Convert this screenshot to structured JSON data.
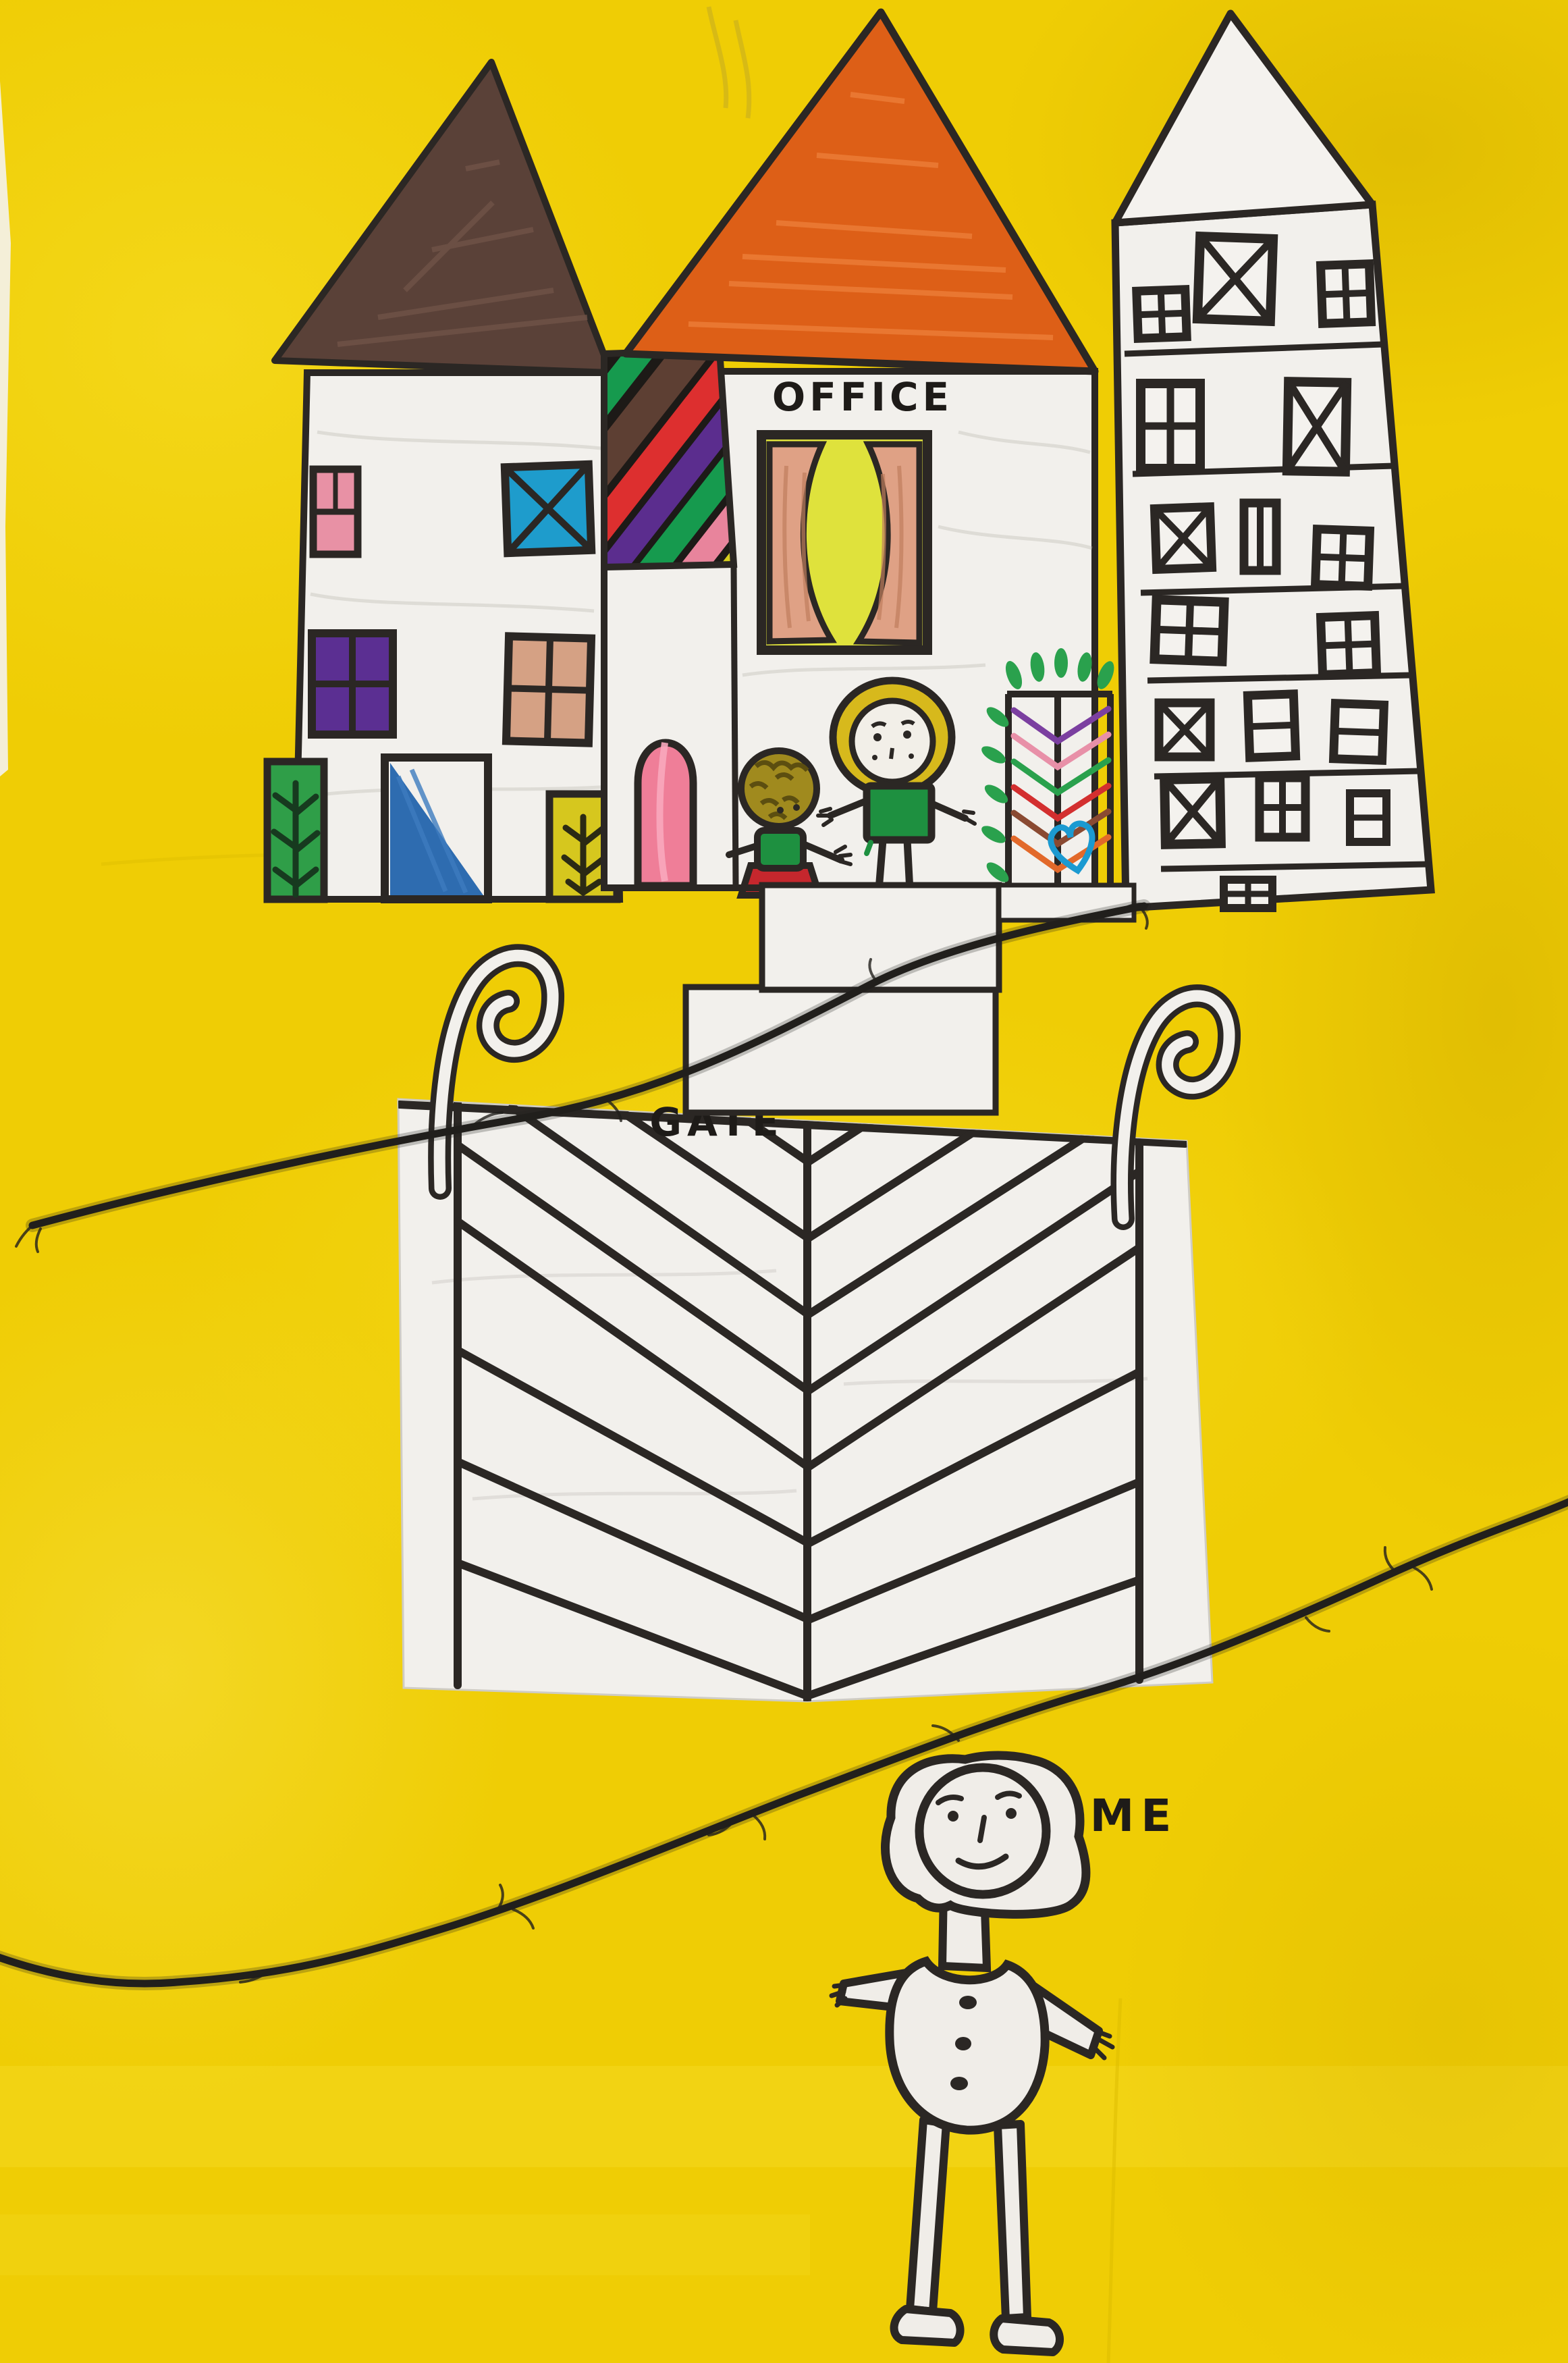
{
  "artwork": {
    "labels": {
      "office": "OFFICE",
      "gate": "GATE",
      "me": "ME"
    },
    "colors": {
      "background_yellow": "#efcd05",
      "paper_white": "#f2f0ec",
      "ink_black": "#2b2724",
      "string_black": "#211f1c",
      "left_roof_brown": "#5a4138",
      "middle_roof_orange": "#dd5f17",
      "window_pink": "#e891a5",
      "window_blue_x": "#1e9ccc",
      "window_purple": "#5b2f92",
      "window_tan": "#d5a184",
      "door_green": "#2f9e48",
      "door_blue": "#2e6cb0",
      "door_yellow": "#d6c71e",
      "arch_door_pink": "#ef7e98",
      "curtain_salmon": "#dfa185",
      "window_glow_yellow": "#dfe23c",
      "stripe_colors": [
        "#e06a1e",
        "#169a4e",
        "#5d3f33",
        "#dd2f2f",
        "#5b2d8e",
        "#169a4e",
        "#e8849c",
        "#d6cf1e",
        "#2196d0"
      ],
      "girl_hair_yellow": "#d7b91c",
      "child_hair_olive": "#a08a1e",
      "shirt_green": "#1e9040",
      "skirt_red": "#c5272d",
      "plant_green": "#2aa14d",
      "heart_blue": "#1b9ad1",
      "plant_chevrons": [
        "#7b3fa0",
        "#e890a8",
        "#2aa14d",
        "#d32f2f",
        "#8a4a32",
        "#e2692a"
      ]
    }
  }
}
